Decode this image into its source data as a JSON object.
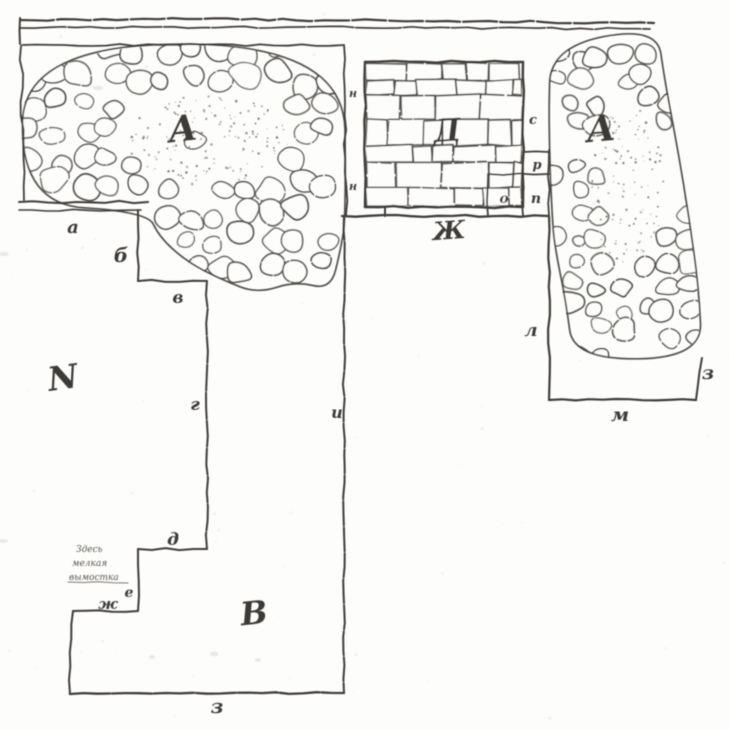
{
  "figure": {
    "type": "hand-drawn excavation plan (scanned)",
    "paper_color": "#fdfdfb",
    "ink_color": "#3f3d3a"
  },
  "labels": {
    "area_a_left": "А",
    "area_a_right": "А",
    "area_d": "Д",
    "area_b": "В",
    "area_n": "N",
    "wall_zh": "Ж",
    "pt_a": "а",
    "pt_b": "б",
    "pt_v": "в",
    "pt_g": "г",
    "pt_d": "д",
    "pt_e": "е",
    "pt_zh": "ж",
    "pt_z": "з",
    "pt_i": "и",
    "pt_l": "л",
    "pt_m": "м",
    "pt_n_upper": "н",
    "pt_n_lower": "н",
    "pt_o": "о",
    "pt_p": "п",
    "pt_r": "р",
    "pt_s": "с",
    "pt_z_right": "з"
  },
  "annotation": {
    "lines": [
      "Здесь",
      "мелкая",
      "вымостка"
    ]
  }
}
